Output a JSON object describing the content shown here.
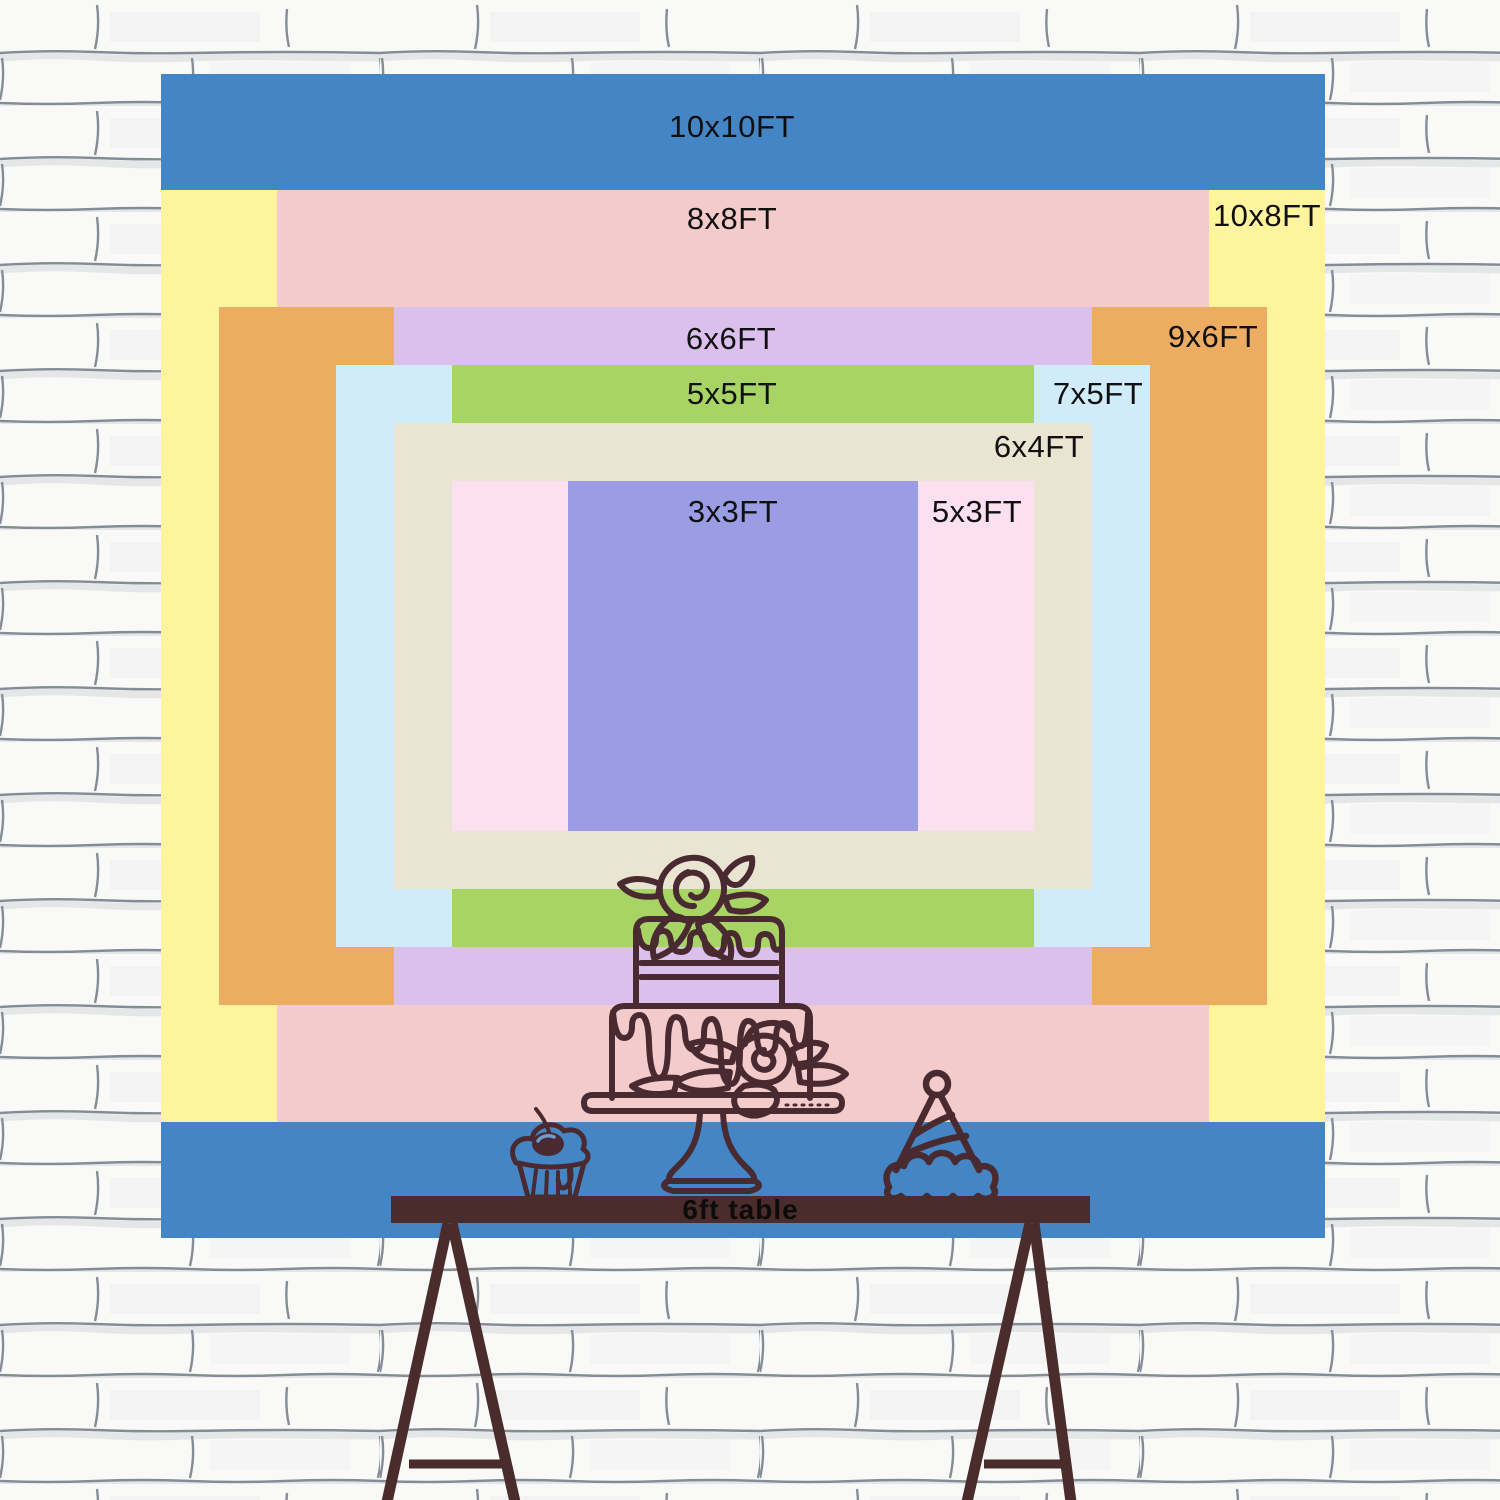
{
  "backdrop": {
    "unit": "FT",
    "sizes": [
      {
        "label": "10x10FT",
        "w_ft": 10,
        "h_ft": 10,
        "color": "#4486c5",
        "label_x": 732,
        "label_y": 127
      },
      {
        "label": "10x8FT",
        "w_ft": 10,
        "h_ft": 8,
        "color": "#fdf49d",
        "label_x": 1267,
        "label_y": 216
      },
      {
        "label": "8x8FT",
        "w_ft": 8,
        "h_ft": 8,
        "color": "#f3cbcb",
        "label_x": 732,
        "label_y": 219
      },
      {
        "label": "9x6FT",
        "w_ft": 9,
        "h_ft": 6,
        "color": "#ecac62",
        "label_x": 1213,
        "label_y": 337
      },
      {
        "label": "6x6FT",
        "w_ft": 6,
        "h_ft": 6,
        "color": "#dbc0ed",
        "label_x": 731,
        "label_y": 339
      },
      {
        "label": "7x5FT",
        "w_ft": 7,
        "h_ft": 5,
        "color": "#d0ecfa",
        "label_x": 1098,
        "label_y": 394
      },
      {
        "label": "5x5FT",
        "w_ft": 5,
        "h_ft": 5,
        "color": "#a8d465",
        "label_x": 732,
        "label_y": 394
      },
      {
        "label": "6x4FT",
        "w_ft": 6,
        "h_ft": 4,
        "color": "#eae5d3",
        "label_x": 1039,
        "label_y": 447
      },
      {
        "label": "5x3FT",
        "w_ft": 5,
        "h_ft": 3,
        "color": "#fcdff0",
        "label_x": 977,
        "label_y": 512
      },
      {
        "label": "3x3FT",
        "w_ft": 3,
        "h_ft": 3,
        "color": "#9a9de3",
        "label_x": 733,
        "label_y": 512
      }
    ]
  },
  "table": {
    "label": "6ft table"
  },
  "decorations": [
    "tiered-cake-icon",
    "cupcake-icon",
    "party-hat-icon"
  ],
  "colors": {
    "label_text": "#101010",
    "table_brown": "#4b2c2c",
    "doodle_stroke": "#4a2a31",
    "wall_line": "#868c96"
  }
}
